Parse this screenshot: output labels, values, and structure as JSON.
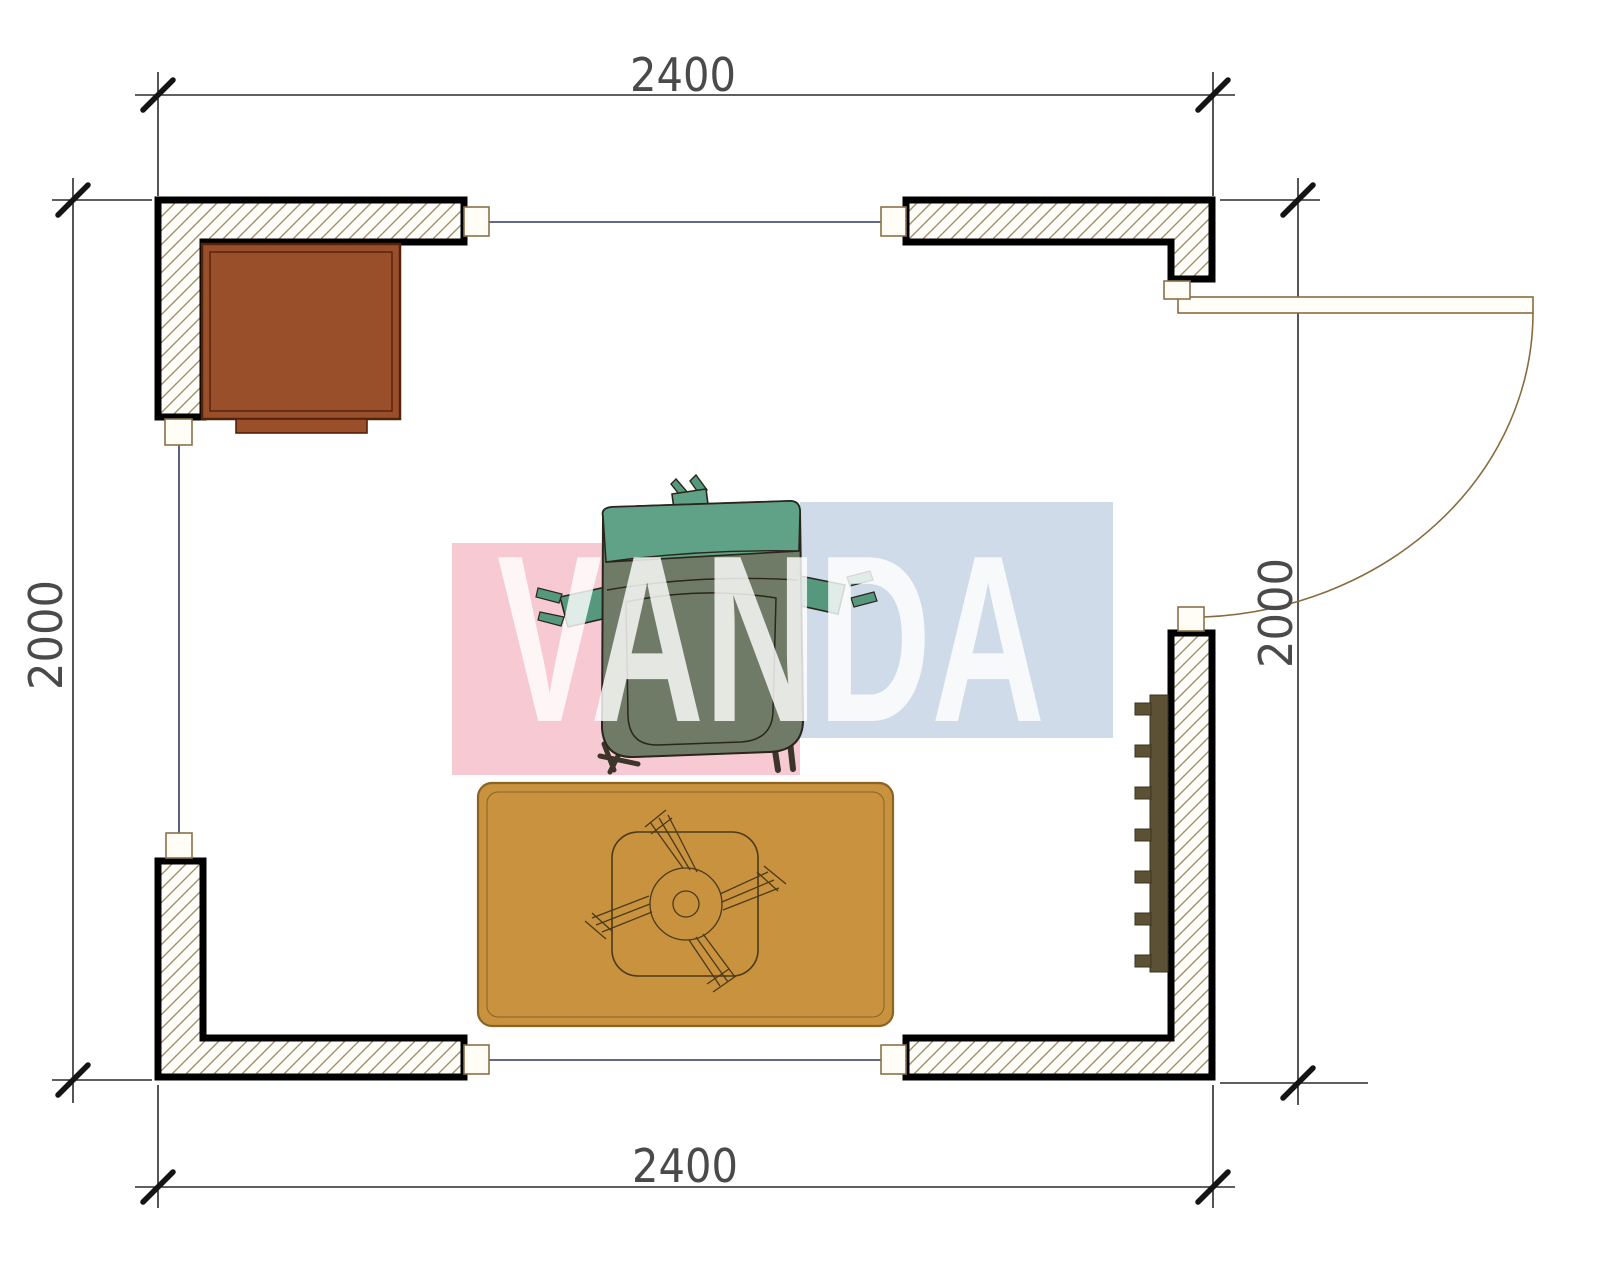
{
  "drawing": {
    "type": "floor-plan",
    "dimensions": {
      "top": "2400",
      "bottom": "2400",
      "left": "2000",
      "right": "2000"
    },
    "watermark": {
      "text": "VANDA",
      "pink_color": "#f7c9d2",
      "blue_color": "#cfdbe9",
      "text_color": "rgba(255,255,255,0.82)"
    },
    "furniture": [
      {
        "name": "desk",
        "color": "#9a4f2b"
      },
      {
        "name": "office-chair",
        "body_color": "#6f7b67",
        "accent_color": "#5fa287"
      },
      {
        "name": "rug",
        "color": "#c8923f"
      },
      {
        "name": "round-table-base",
        "outline_color": "#4a3a18"
      },
      {
        "name": "radiator",
        "color": "#5c5134"
      },
      {
        "name": "door",
        "line_color": "#8a6b3f"
      }
    ],
    "colors": {
      "wall_outline": "#000000",
      "wall_hatch": "#a39069",
      "dimension_line": "#2b2b2b",
      "opening_line": "#2e3a66",
      "jamb_fill": "#fffdf5",
      "jamb_stroke": "#8a7148"
    }
  }
}
